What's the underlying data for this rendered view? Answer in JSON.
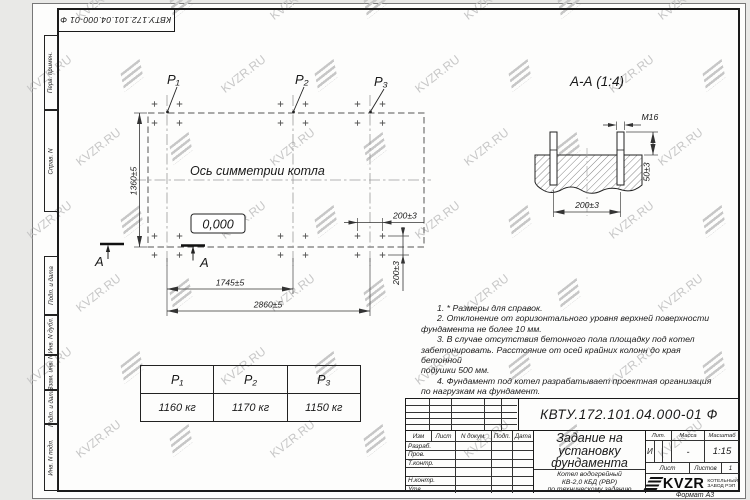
{
  "watermark": {
    "text": "KVZR.RU"
  },
  "frame": {
    "stamp_top": "КВТУ.172.101.04.000-01 Ф",
    "format_label": "Формат А3",
    "strip_labels": [
      "Перв. примен.",
      "Справ. N",
      "Подп. и дата",
      "Инв. N дубл.",
      "Взам. инв. N",
      "Подп. и дата",
      "Инв. N подл."
    ]
  },
  "plan": {
    "point_labels": [
      "P₁",
      "P₂",
      "P₃"
    ],
    "axis_label": "Ось симметрии котла",
    "elevation_label": "0,000",
    "dim_height": "1360±5",
    "dim_p1_p2": "1745±5",
    "dim_p1_p3": "2860±5",
    "dim_bolt_x": "200±3",
    "dim_bolt_y": "200±3",
    "section_letter": "А"
  },
  "section_view": {
    "title": "А-А (1:4)",
    "thread_label": "М16",
    "dim_spacing": "200±3",
    "dim_protrusion": "50±3"
  },
  "notes": {
    "lines": [
      "1. * Размеры для справок.",
      "2. Отклонение от горизонтального уровня верхней поверхности",
      "фундамента не более 10 мм.",
      "3. В случае отсутствия бетонного пола площадку под котел",
      "забетонировать. Расстояние от осей крайних колонн до края бетонной",
      "подушки 500 мм.",
      "4. Фундамент под котел разрабатывает проектная организация",
      "по нагрузкам на фундамент."
    ]
  },
  "load_table": {
    "headers": [
      "P₁",
      "P₂",
      "P₃"
    ],
    "values": [
      "1160 кг",
      "1170 кг",
      "1150 кг"
    ]
  },
  "title_block": {
    "doc_number": "КВТУ.172.101.04.000-01 Ф",
    "title_lines": [
      "Задание на",
      "установку",
      "фундамента"
    ],
    "product_lines": [
      "Котел водогрейный",
      "КВ-2,0 КБД (РВР)",
      "по техническому заданию"
    ],
    "col_headers": [
      "Изм",
      "Лист",
      "N докум.",
      "Подп.",
      "Дата"
    ],
    "row_labels": [
      "Разраб.",
      "Пров.",
      "Т.контр.",
      "",
      "Н.контр.",
      "Утв."
    ],
    "lit_label": "Лит.",
    "mass_label": "Масса",
    "scale_label": "Масштаб",
    "lit_value": "И",
    "mass_value": "-",
    "scale_value": "1:15",
    "sheet_label": "Лист",
    "sheets_label": "Листов",
    "sheets_value": "1",
    "logo_text": "KVZR",
    "logo_sub": [
      "КОТЕЛЬНЫЙ",
      "ЗАВОД РЭП"
    ]
  }
}
